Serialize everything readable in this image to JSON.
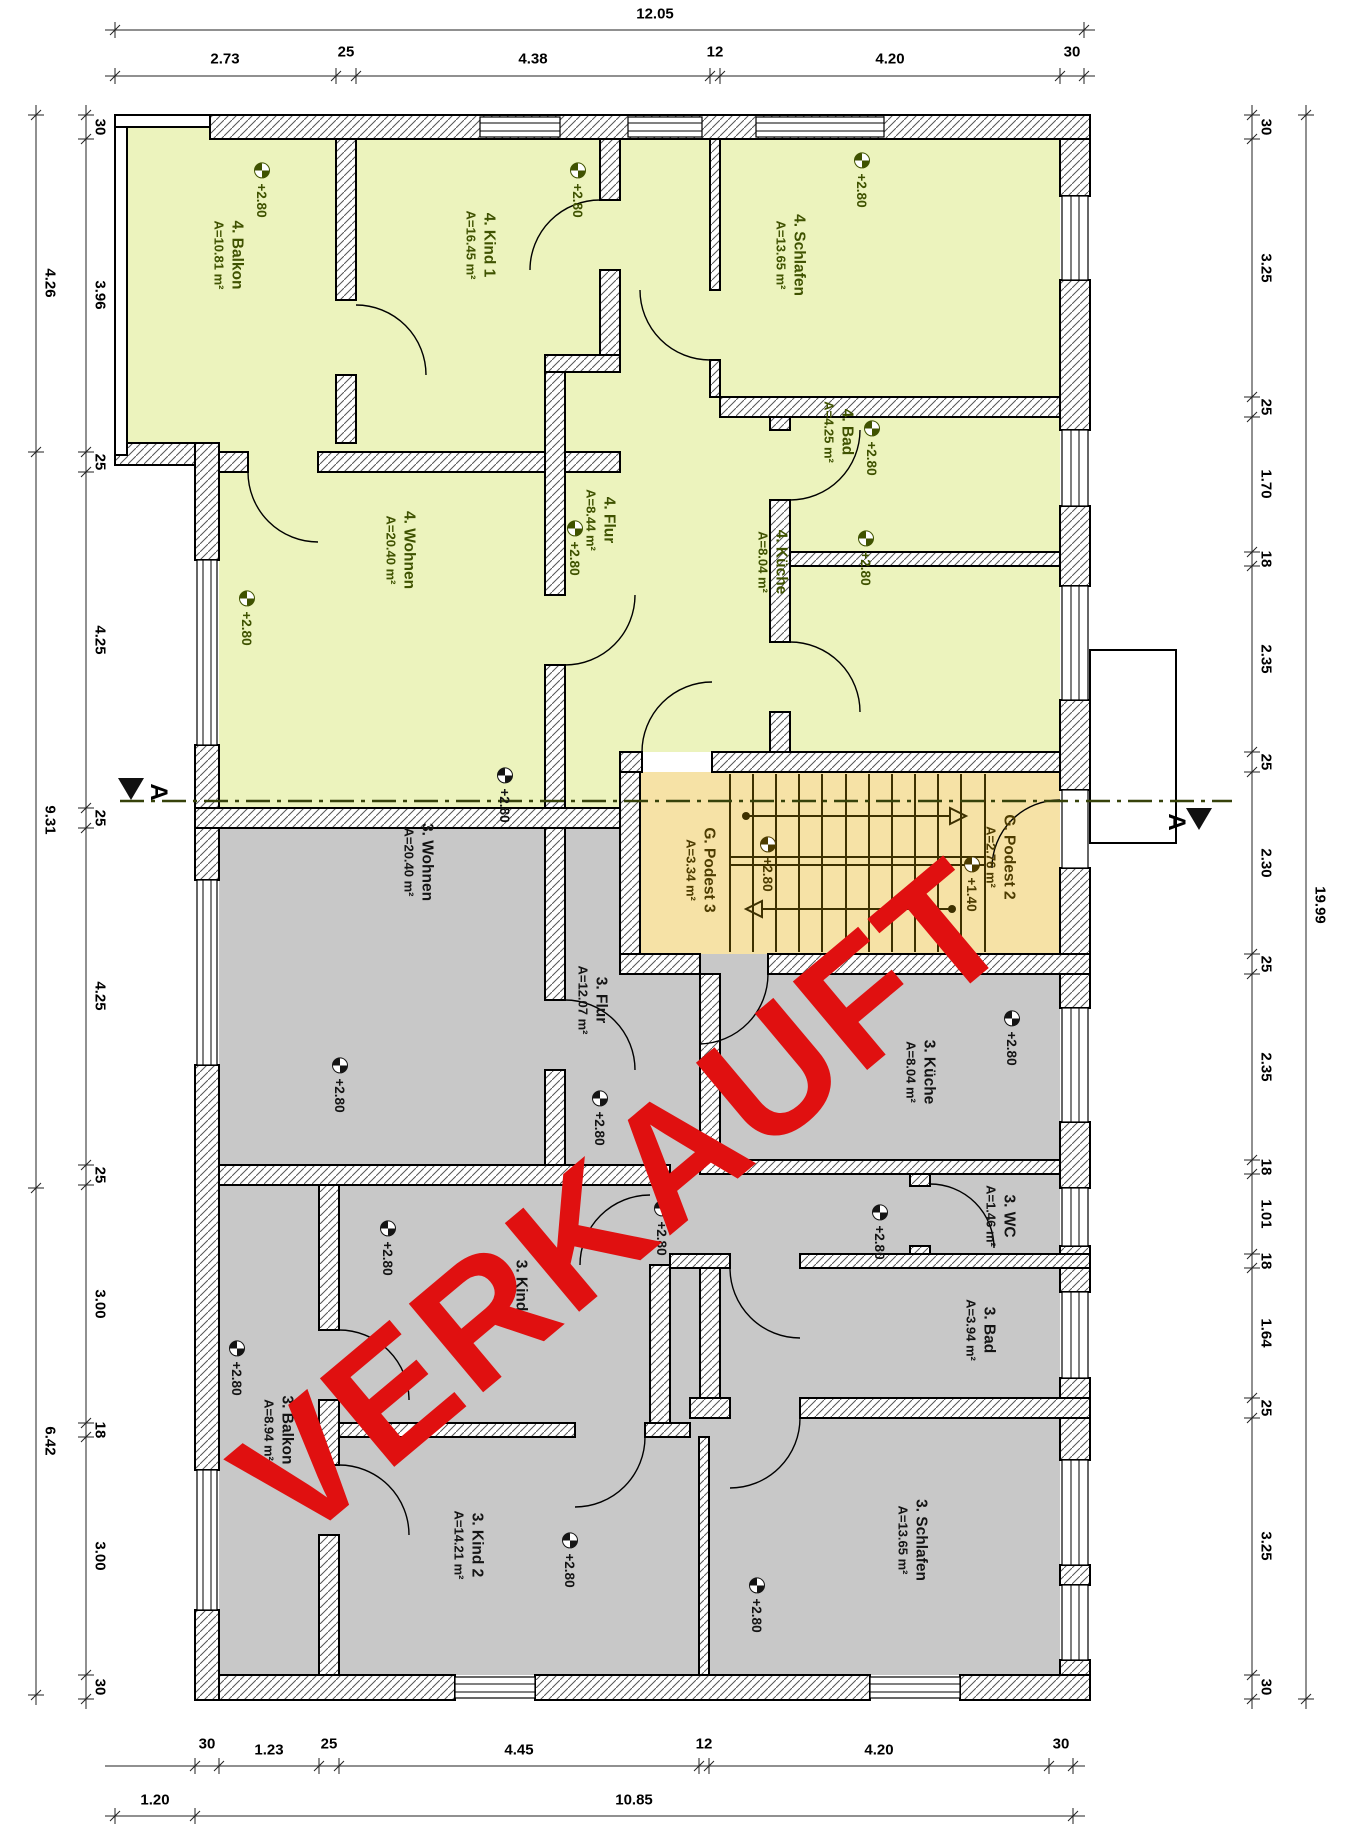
{
  "stamp": {
    "text": "VERKAUFT",
    "color": "#e01010"
  },
  "section": {
    "label": "A"
  },
  "colors": {
    "apartment4_fill": "#ecf3bd",
    "apartment3_fill": "#c8c8c8",
    "stair_fill": "#f6e2a6",
    "apartment4_text": "#3f5200",
    "stair_text": "#4d3c00",
    "apartment3_text": "#141414",
    "stamp_red": "#e01010"
  },
  "rooms": {
    "balkon4": {
      "name": "4. Balkon",
      "area": "A=10.81 m²",
      "level": "+2.80"
    },
    "kind1_4": {
      "name": "4. Kind 1",
      "area": "A=16.45 m²",
      "level": "+2.80"
    },
    "schlafen4": {
      "name": "4. Schlafen",
      "area": "A=13.65 m²",
      "level": "+2.80"
    },
    "bad4": {
      "name": "4. Bad",
      "area": "A=4.25 m²",
      "level": "+2.80"
    },
    "flur4": {
      "name": "4. Flur",
      "area": "A=8.44 m²",
      "level": "+2.80"
    },
    "kueche4": {
      "name": "4. Küche",
      "area": "A=8.04 m²",
      "level": "+2.80"
    },
    "wohnen4": {
      "name": "4. Wohnen",
      "area": "A=20.40 m²",
      "level": "+2.80"
    },
    "podest3": {
      "name": "G. Podest 3",
      "area": "A=3.34 m²",
      "level": "+2.80"
    },
    "podest2": {
      "name": "G. Podest 2",
      "area": "A=2.76 m²",
      "level": "+1.40"
    },
    "wohnen3": {
      "name": "3. Wohnen",
      "area": "A=20.40 m²",
      "level": "+2.80"
    },
    "kueche3": {
      "name": "3. Küche",
      "area": "A=8.04 m²",
      "level": "+2.80"
    },
    "flur3": {
      "name": "3. Flur",
      "area": "A=12.07 m²",
      "level": "+2.80"
    },
    "wc3": {
      "name": "3. WC",
      "area": "A=1.46 m²"
    },
    "bad3": {
      "name": "3. Bad",
      "area": "A=3.94 m²",
      "level": "+2.80"
    },
    "kind1_3": {
      "name": "3. Kind 1",
      "area": "A=9.96 m²",
      "level": "+2.80"
    },
    "balkon3": {
      "name": "3. Balkon",
      "area": "A=8.94 m²",
      "level": "+2.80"
    },
    "kind2_3": {
      "name": "3. Kind 2",
      "area": "A=14.21 m²",
      "level": "+2.80"
    },
    "schlafen3": {
      "name": "3. Schlafen",
      "area": "A=13.65 m²",
      "level": "+2.80"
    }
  },
  "extra_levels": [
    "+2.80",
    "+2.80",
    "+2.80"
  ],
  "dims": {
    "top": {
      "total": "12.05",
      "segments": [
        "2.73",
        "25",
        "4.38",
        "12",
        "4.20",
        "30"
      ]
    },
    "bottom": {
      "segments": [
        "30",
        "1.23",
        "25",
        "4.45",
        "12",
        "4.20",
        "30"
      ],
      "row2": [
        "1.20",
        "10.85"
      ]
    },
    "left": {
      "outer": [
        "4.26",
        "9.31",
        "6.42"
      ],
      "inner": [
        "30",
        "3.96",
        "25",
        "4.25",
        "25",
        "4.25",
        "25",
        "3.00",
        "18",
        "3.00",
        "30"
      ]
    },
    "right": {
      "outer": "19.99",
      "inner": [
        "30",
        "3.25",
        "25",
        "1.70",
        "18",
        "2.35",
        "25",
        "2.30",
        "25",
        "2.35",
        "18",
        "1.01",
        "18",
        "1.64",
        "25",
        "3.25",
        "30"
      ]
    }
  }
}
